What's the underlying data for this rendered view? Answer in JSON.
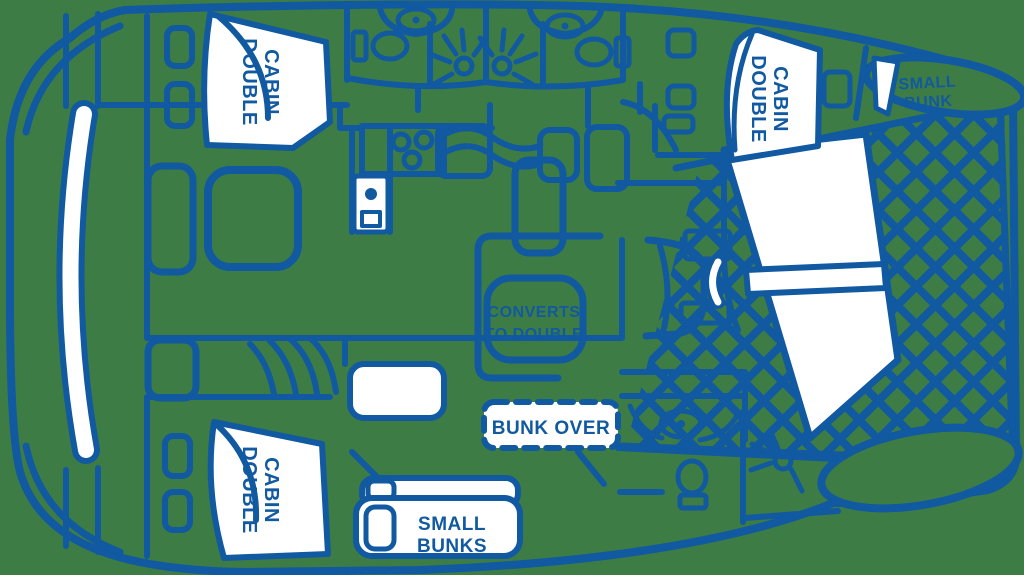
{
  "colors": {
    "background": "#3E7C46",
    "line": "#1159A0",
    "fill": "#FFFFFF"
  },
  "icons": {
    "trampoline_net": "diagonal-crosshatch",
    "shower": "circle-with-rays",
    "toilet": "oval-with-tank",
    "sink": "oval-with-drain-dot",
    "stove": "three-burner-rings",
    "stairs": "nested-arcs",
    "door_swing": "white-arc"
  },
  "labels": {
    "double_cabin": {
      "line1": "DOUBLE",
      "line2": "CABIN"
    },
    "small_bunk": {
      "line1": "SMALL",
      "line2": "BUNK"
    },
    "converts_to_double": {
      "line1": "CONVERTS",
      "line2": "TO DOUBLE"
    },
    "bunk_over": {
      "text": "BUNK OVER"
    },
    "small_bunks": {
      "line1": "SMALL",
      "line2": "BUNKS"
    }
  }
}
